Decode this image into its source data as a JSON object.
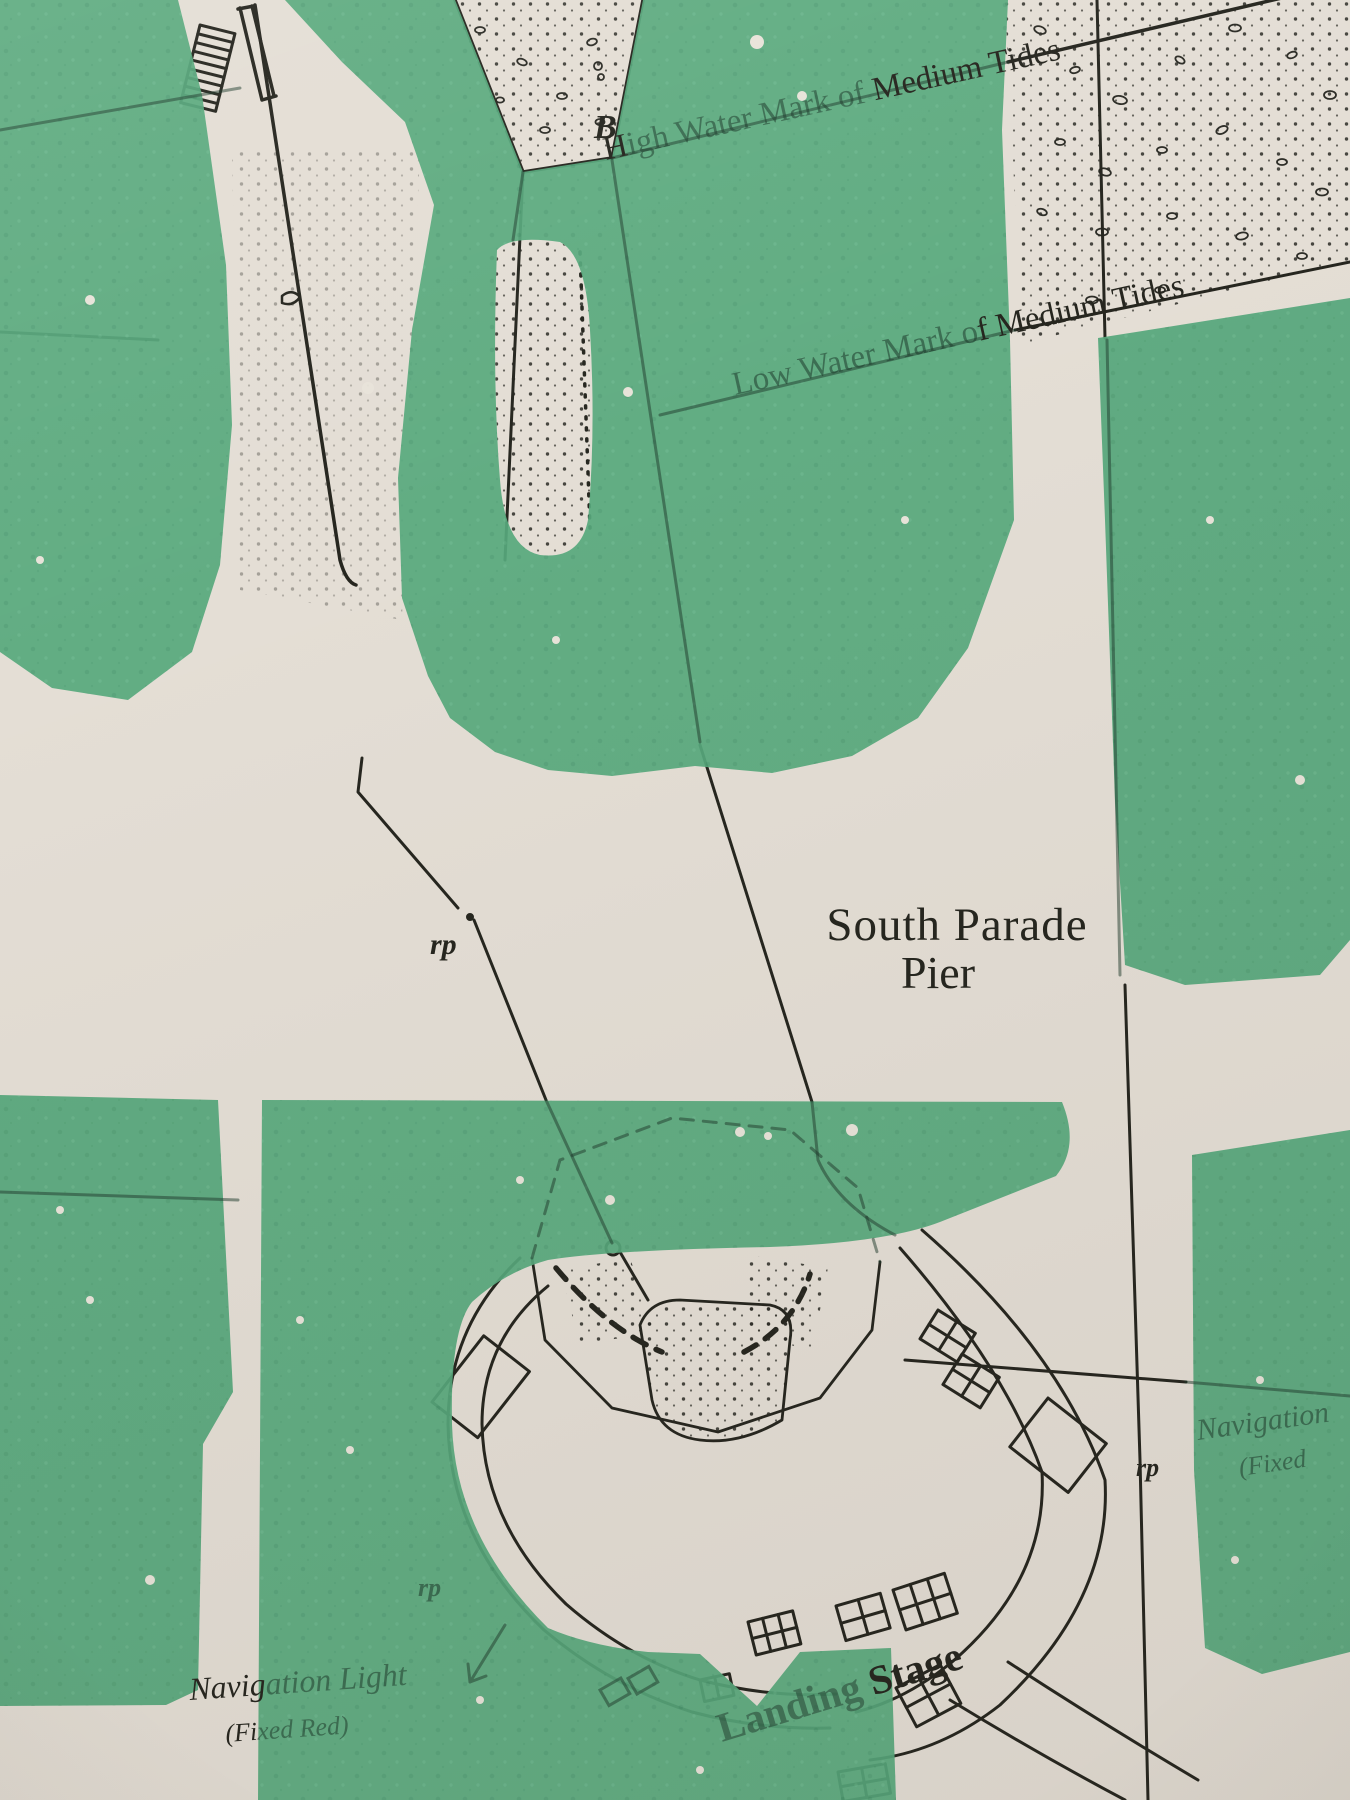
{
  "photo": {
    "description": "printed Ordnance Survey style map of South Parade Pier overprinted with large green letters",
    "colors": {
      "paper": "#e4ded5",
      "overprint_green": "#57a97d",
      "ink": "#26261f",
      "ghost_ink": "#1d3a2b"
    },
    "labels": {
      "high_water_mark": {
        "full": "High Water Mark of Medium Tides",
        "dark_lead": "H",
        "faint_part": "igh Water Mark of ",
        "dark_part": "Medium Tides"
      },
      "low_water_mark": {
        "full": "Low Water Mark of Medium Tides",
        "faint_part": "Low Water Mark o",
        "dark_part": "f Medium Tides"
      },
      "pier": {
        "line1": "South Parade",
        "line2": "Pier"
      },
      "landing_stage": {
        "full": "Landing Stage",
        "faint_part": "Landing ",
        "dark_part": "Stage"
      },
      "nav_light_left": {
        "full": "Navigation Light (Fixed Red)",
        "line1_dark": "Navig",
        "line1_faint": "ation Light",
        "line2_dark": "(Fi",
        "line2_faint": "xed Red)"
      },
      "nav_light_right": {
        "line1": "Navigation",
        "line2": "(Fixed"
      },
      "point_b": "B",
      "rp_left": "rp",
      "rp_right": "rp",
      "rp_lower": "rp"
    }
  }
}
